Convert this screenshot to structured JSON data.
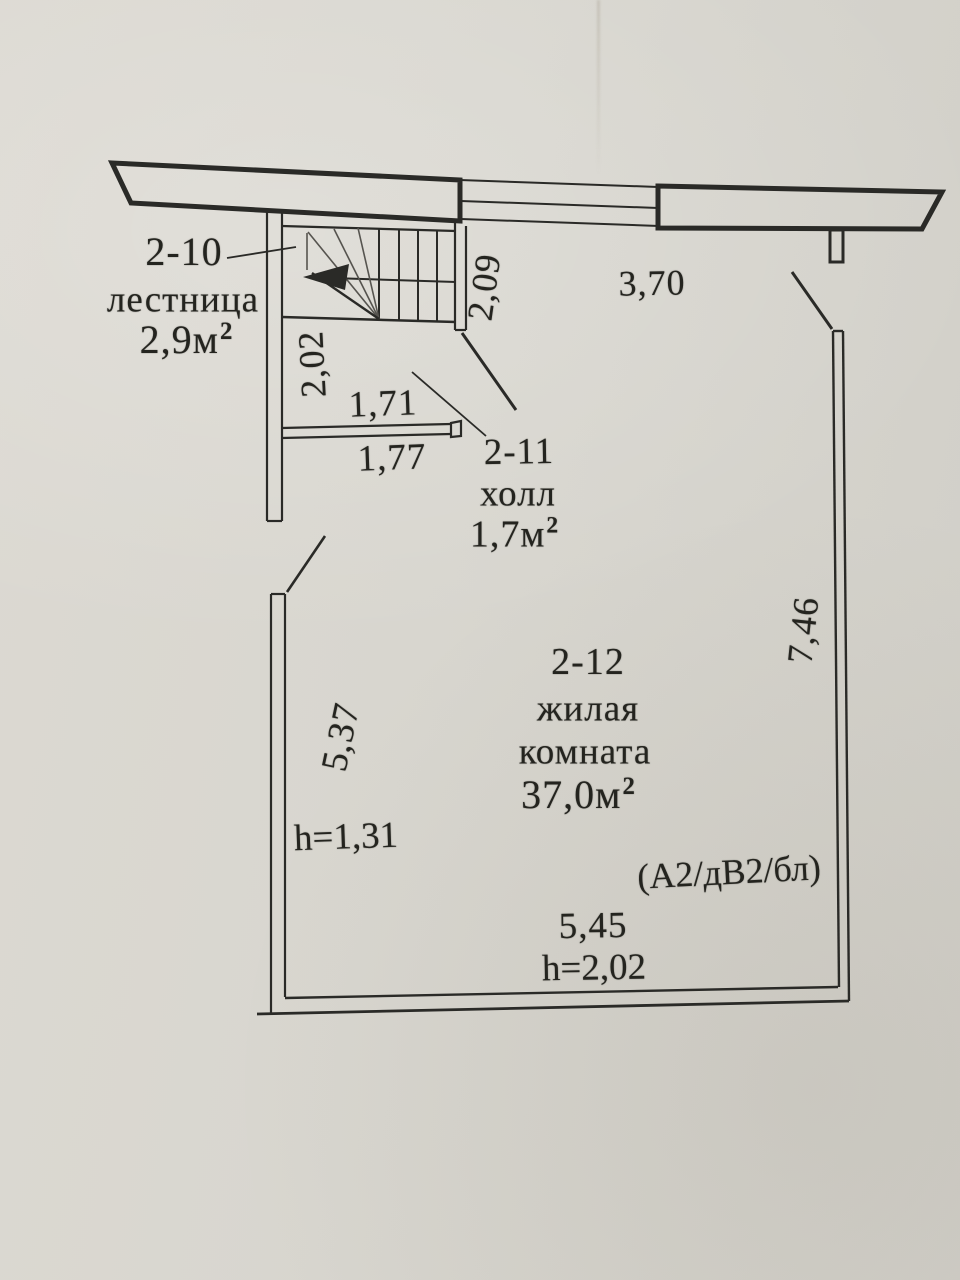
{
  "document_type": "floor-plan",
  "colors": {
    "paper": "#d8d6cf",
    "ink": "#2a2a27",
    "faint_ink": "#56544f"
  },
  "rooms": [
    {
      "id": "2-10",
      "name": "лестница",
      "area_value": "2,9м",
      "area_sup": "2"
    },
    {
      "id": "2-11",
      "name": "холл",
      "area_value": "1,7м",
      "area_sup": "2"
    },
    {
      "id": "2-12",
      "name_line1": "жилая",
      "name_line2": "комната",
      "area_value": "37,0м",
      "area_sup": "2"
    }
  ],
  "dims": {
    "stair_width": "2,09",
    "top_wall": "3,70",
    "hall_depth": "2,02",
    "partition_upper": "1,71",
    "partition_lower": "1,77",
    "left_wall": "5,37",
    "right_wall": "7,46",
    "bottom_wall": "5,45",
    "height_left": "h=1,31",
    "height_bottom": "h=2,02"
  },
  "note": "(А2/дВ2/бл)"
}
